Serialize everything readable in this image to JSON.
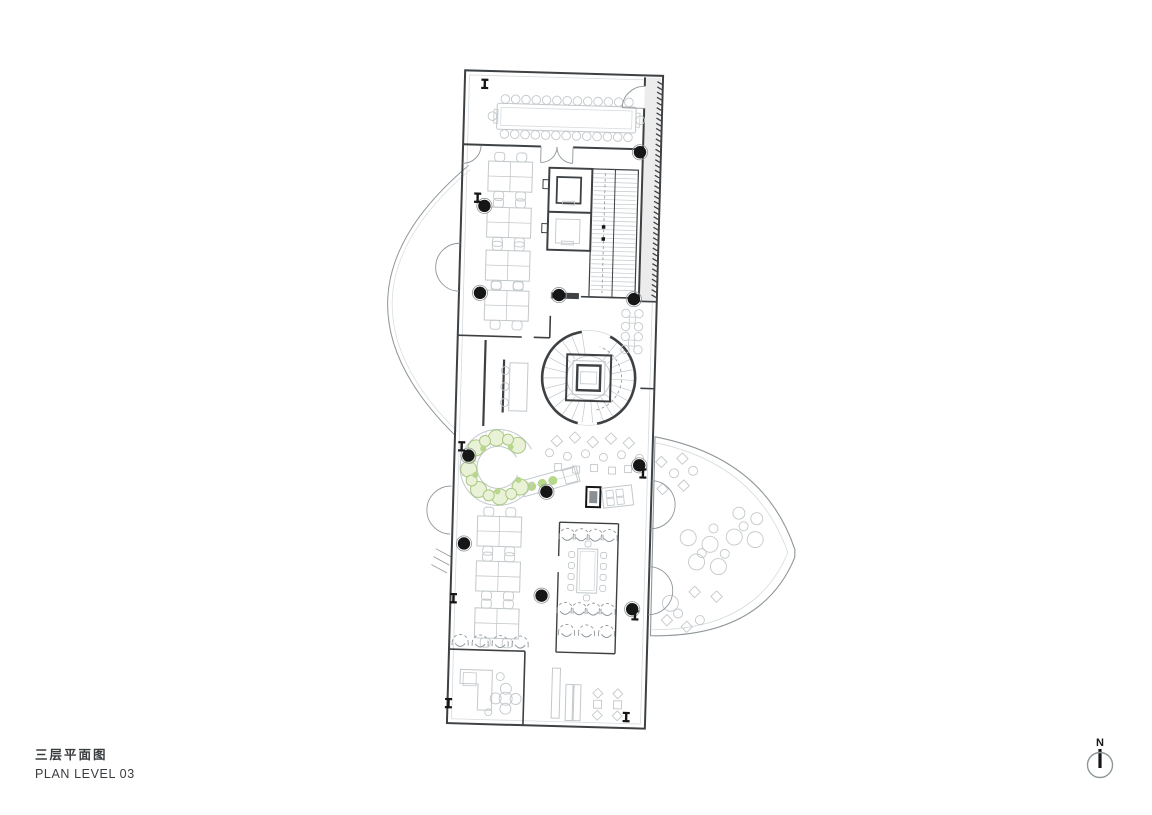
{
  "title_block": {
    "title_cn": "三层平面图",
    "title_en": "PLAN LEVEL 03"
  },
  "north_arrow": {
    "label": "N"
  },
  "colors": {
    "wall": "#3e4144",
    "furn": "#c3c8cb",
    "furn2": "#d7dbdd",
    "mid": "#8f969a",
    "corr": "#ececed",
    "col": "#161616",
    "plantFill": "#e9f1d6",
    "plantStroke": "#abc883",
    "plantAccent": "#b7d78a",
    "text": "#393c3f",
    "bg": "#ffffff"
  },
  "plan_elements": [
    "building-shell",
    "conference-room-long-table",
    "open-office-desk-clusters",
    "elevator-stair-core",
    "spiral-stair",
    "circular-planter-lounge",
    "cafe-tables",
    "bar-counter",
    "diagonal-bench",
    "service-box",
    "meeting-room",
    "lounge-pods",
    "fan-terrace-with-poufs",
    "west-canopy-arc",
    "structural-columns",
    "fire-hose-cabinets",
    "door-swings",
    "north-arrow"
  ]
}
